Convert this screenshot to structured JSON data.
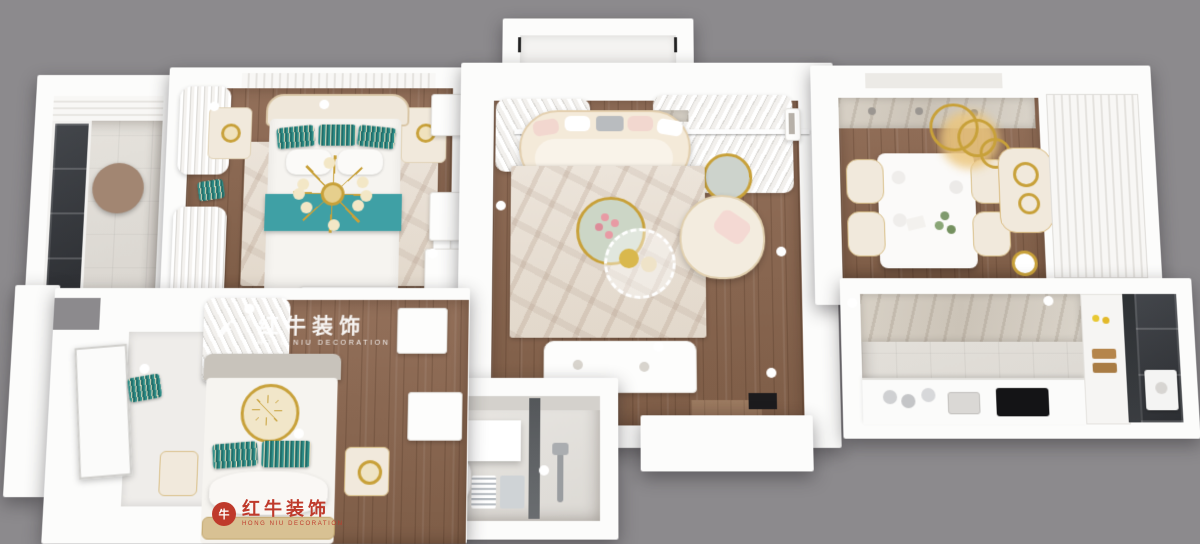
{
  "scene": {
    "description": "3D top-down render of an apartment floor plan: two bedrooms (teal and white bedding), central living room with curved cream sofa, dining room with gold chandelier, galley kitchen, bathroom and three balconies",
    "background": "#8c8a8d"
  },
  "colors": {
    "bg": "#8c8a8d",
    "wall": "#fcfcfb",
    "wood1": "#93705a",
    "wood2": "#7e5d47",
    "teal": "#3fa0a5",
    "gold": "#c8a13a",
    "red": "#bf3a2b",
    "glassdark": "#2f3236",
    "rugcream": "#e9e1d5"
  },
  "watermarks": {
    "floor": {
      "brand_zh": "红牛装饰",
      "brand_en": "HONG NIU DECORATION",
      "registered": "®"
    },
    "footer": {
      "seal_glyph": "牛",
      "brand_zh": "红牛装饰",
      "brand_en": "HONG NIU DECORATION"
    }
  }
}
